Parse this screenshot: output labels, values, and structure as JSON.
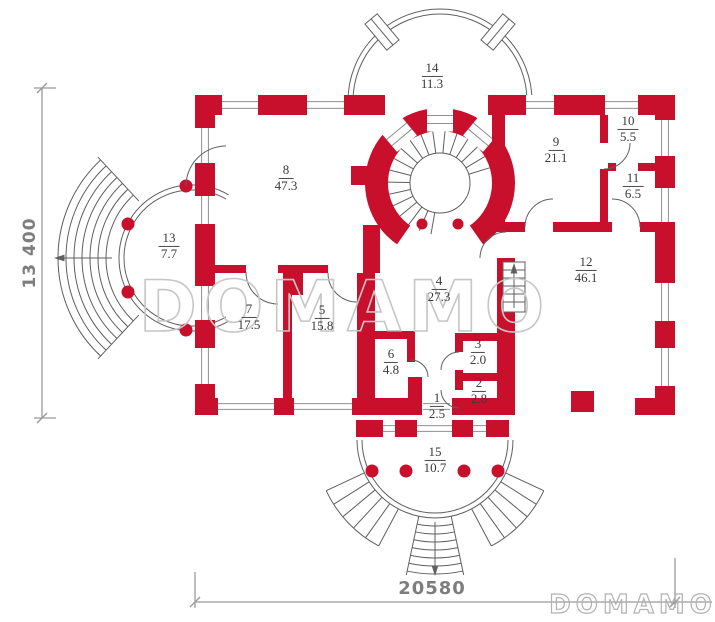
{
  "title": "House floor plan",
  "colors": {
    "wall_red": "#c8102d",
    "outline": "#5f5f5f",
    "window_line": "#8f8f8f",
    "dimension": "#9a9a9a",
    "watermark_center": "#c6c6c6",
    "watermark_corner": "#b2b2b2"
  },
  "watermark": {
    "center": "DOMAMO",
    "corner": "DOMAMO"
  },
  "dimensions": {
    "height_label": "13 400",
    "width_label": "20580"
  },
  "rooms": [
    {
      "number": "1",
      "area": "2.5",
      "x": 437,
      "y": 406
    },
    {
      "number": "2",
      "area": "2.8",
      "x": 479,
      "y": 391
    },
    {
      "number": "3",
      "area": "2.0",
      "x": 478,
      "y": 352
    },
    {
      "number": "4",
      "area": "27.3",
      "x": 439,
      "y": 289
    },
    {
      "number": "5",
      "area": "15.8",
      "x": 322,
      "y": 318
    },
    {
      "number": "6",
      "area": "4.8",
      "x": 391,
      "y": 362
    },
    {
      "number": "7",
      "area": "17.5",
      "x": 249,
      "y": 317
    },
    {
      "number": "8",
      "area": "47.3",
      "x": 286,
      "y": 178
    },
    {
      "number": "9",
      "area": "21.1",
      "x": 556,
      "y": 150
    },
    {
      "number": "10",
      "area": "5.5",
      "x": 628,
      "y": 129
    },
    {
      "number": "11",
      "area": "6.5",
      "x": 633,
      "y": 186
    },
    {
      "number": "12",
      "area": "46.1",
      "x": 586,
      "y": 270
    },
    {
      "number": "13",
      "area": "7.7",
      "x": 169,
      "y": 246
    },
    {
      "number": "14",
      "area": "11.3",
      "x": 432,
      "y": 76
    },
    {
      "number": "15",
      "area": "10.7",
      "x": 435,
      "y": 460
    }
  ]
}
